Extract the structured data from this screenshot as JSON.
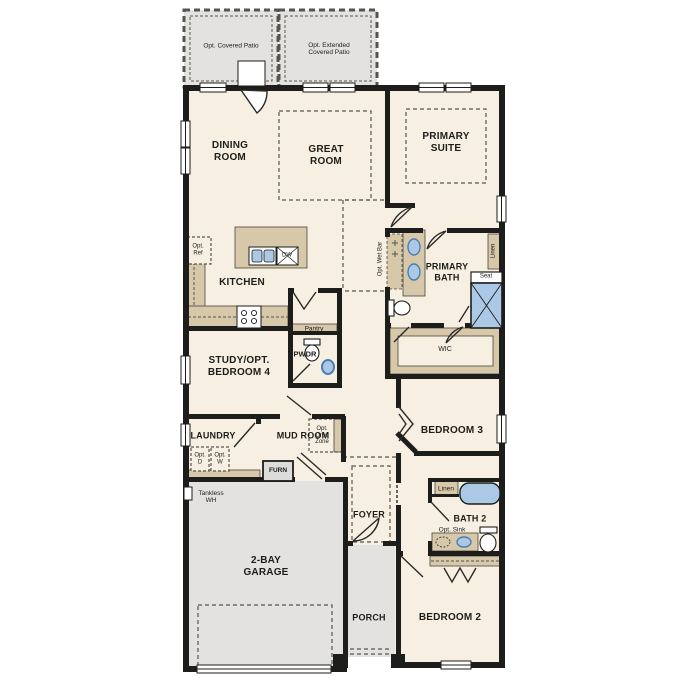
{
  "title": "Single-story floor plan",
  "colors": {
    "floor": "#f7f0e2",
    "concrete": "#e3e2e0",
    "cabinet": "#d6c8a9",
    "fixture": "#abc8e6",
    "fixture_dark": "#4d7eb0",
    "wall": "#1d1d1b",
    "text": "#1d1d1b",
    "dash": "#555550"
  },
  "labels": {
    "opt_covered_patio": "Opt. Covered Patio",
    "opt_extended_covered_patio": "Opt. Extended\nCovered Patio",
    "dining_room": "DINING\nROOM",
    "great_room": "GREAT\nROOM",
    "primary_suite": "PRIMARY\nSUITE",
    "kitchen": "KITCHEN",
    "opt_ref": "Opt.\nRef",
    "dw": "DW",
    "pantry": "Pantry",
    "opt_wet_bar": "Opt. Wet Bar",
    "primary_bath": "PRIMARY\nBATH",
    "linen_primary": "Linen",
    "seat": "Seat",
    "wic": "WIC",
    "study_opt_bedroom4": "STUDY/OPT.\nBEDROOM 4",
    "pwdr": "PWDR",
    "laundry": "LAUNDRY",
    "mud_room": "MUD ROOM",
    "opt_drop_zone": "Opt.\nDrop\nZone",
    "opt_d": "Opt.\nD",
    "opt_w": "Opt.\nW",
    "furn": "FURN",
    "tankless_wh": "Tankless\nWH",
    "bedroom_3": "BEDROOM 3",
    "linen_bath2": "Linen",
    "bath_2": "BATH 2",
    "opt_sink": "Opt. Sink",
    "foyer": "FOYER",
    "two_bay_garage": "2-BAY\nGARAGE",
    "porch": "PORCH",
    "bedroom_2": "BEDROOM 2"
  }
}
